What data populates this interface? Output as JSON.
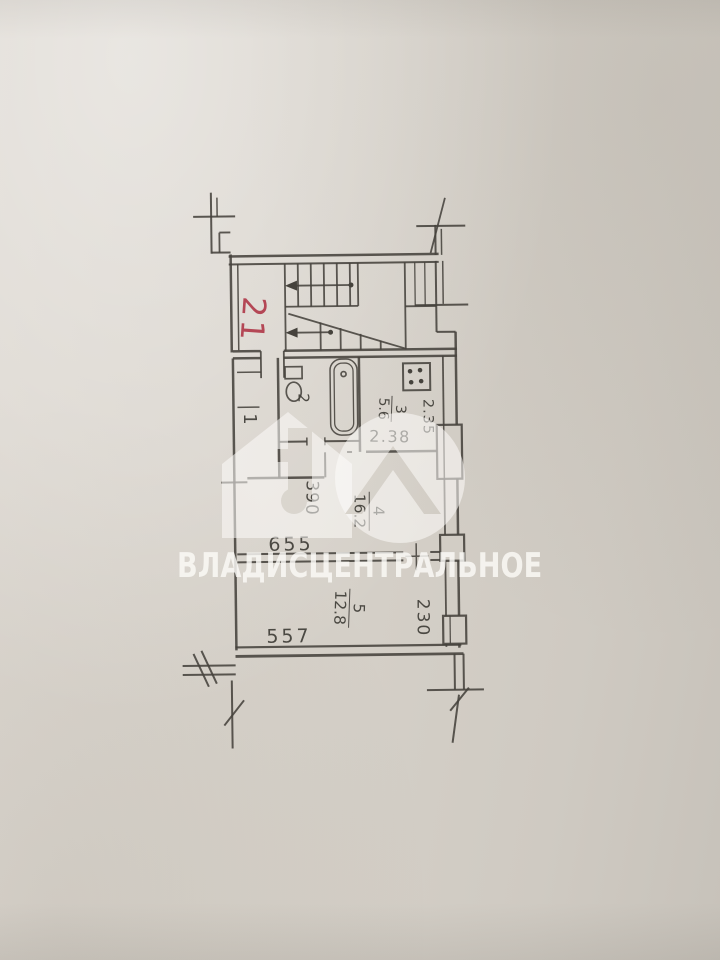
{
  "watermark": {
    "text": "ВЛАДИСЦЕНТРАЛЬНОЕ"
  },
  "plan": {
    "apartment_number": "21",
    "rooms": {
      "hall": {
        "number": "1"
      },
      "bathroom": {
        "number": "2"
      },
      "kitchen": {
        "number": "3",
        "area": "5.6"
      },
      "room4": {
        "number": "4",
        "area": "16.2"
      },
      "room5": {
        "number": "5",
        "area": "12.8"
      }
    },
    "dimensions": {
      "kitchen_width": "2.38",
      "kitchen_depth": "2.35",
      "hall_width": "390",
      "room4_width": "655",
      "room5_width": "557",
      "room5_depth": "230"
    }
  },
  "colors": {
    "paper": "#d6d1c9",
    "ink": "#45423c",
    "red_label": "#b2404f",
    "watermark_white": "#fdfcfa"
  }
}
